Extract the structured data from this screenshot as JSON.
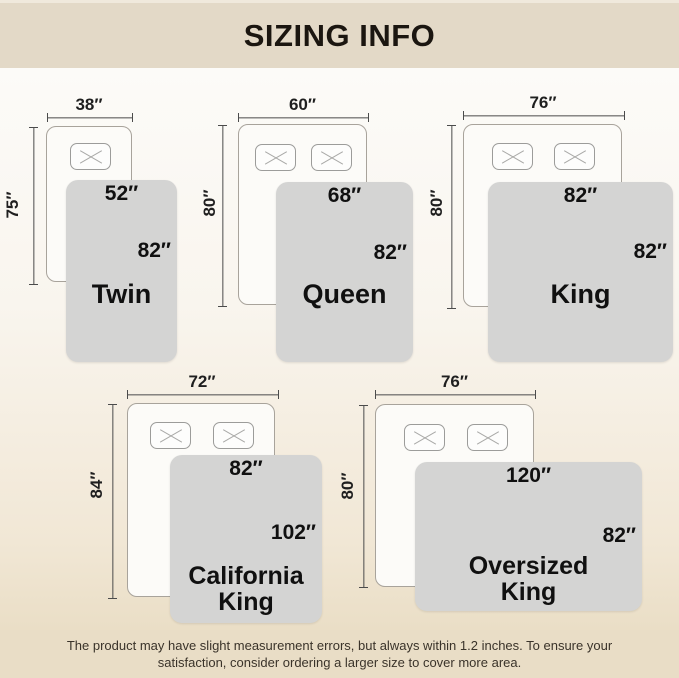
{
  "header": {
    "title": "SIZING INFO"
  },
  "beds": [
    {
      "id": "twin",
      "name": "Twin",
      "bed_width": "38″",
      "bed_length": "75″",
      "blanket_width": "52″",
      "blanket_length": "82″"
    },
    {
      "id": "queen",
      "name": "Queen",
      "bed_width": "60″",
      "bed_length": "80″",
      "blanket_width": "68″",
      "blanket_length": "82″"
    },
    {
      "id": "king",
      "name": "King",
      "bed_width": "76″",
      "bed_length": "80″",
      "blanket_width": "82″",
      "blanket_length": "82″"
    },
    {
      "id": "california-king",
      "name": "California King",
      "bed_width": "72″",
      "bed_length": "84″",
      "blanket_width": "82″",
      "blanket_length": "102″"
    },
    {
      "id": "oversized-king",
      "name": "Oversized King",
      "bed_width": "76″",
      "bed_length": "80″",
      "blanket_width": "120″",
      "blanket_length": "82″"
    }
  ],
  "footer": {
    "line1": "The product may have slight measurement errors, but always within 1.2 inches. To ensure your",
    "line2": "satisfaction, consider ordering a larger size to cover more area."
  },
  "colors": {
    "header_bg": "#e3d9c7",
    "header_text": "#1b1610",
    "footer_bg": "#e9ddc6",
    "footer_text": "#3a332a",
    "blanket": "#d4d4d3",
    "bed_fill": "#fcfbf8",
    "bed_border": "#a8a39b",
    "measure_line": "#4b4b4b",
    "bg_top": "#fcfbf8",
    "bg_bottom": "#eadec6"
  }
}
